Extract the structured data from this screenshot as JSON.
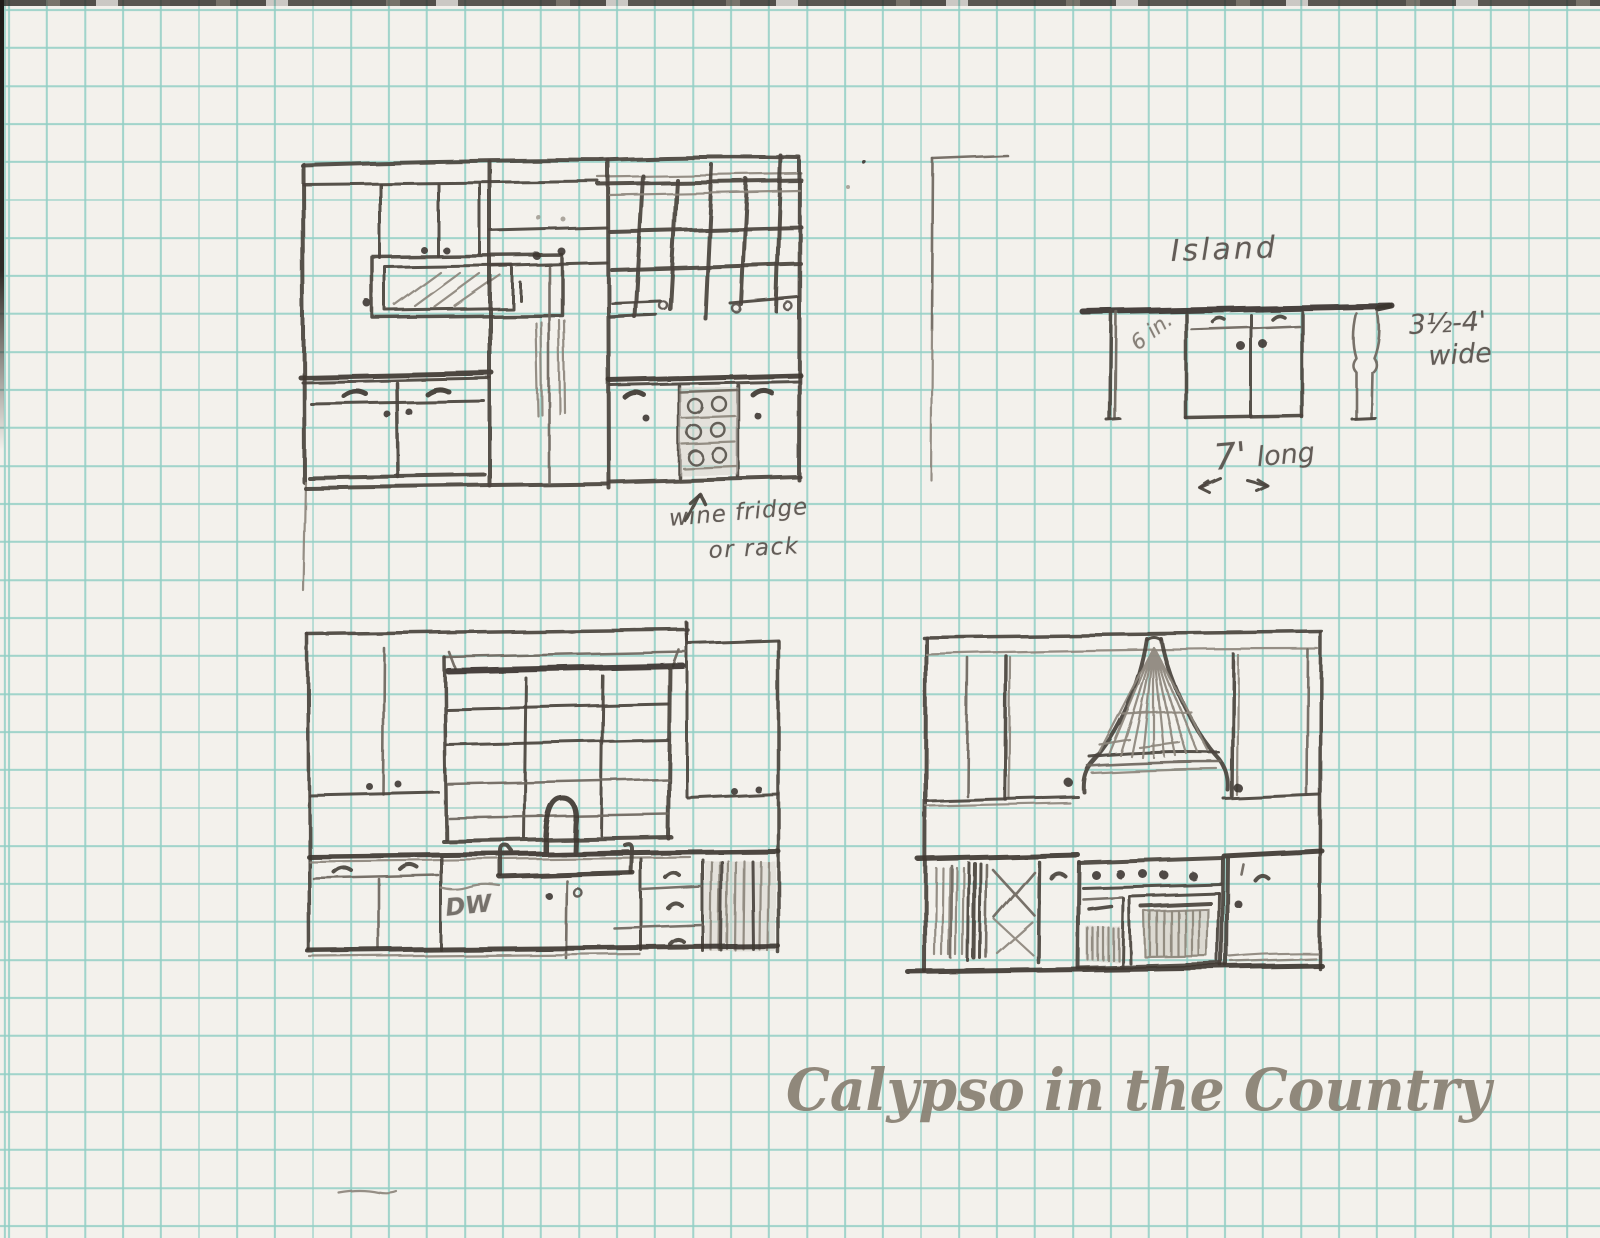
{
  "paper": {
    "background": "#f3f1ec",
    "grid_color": "#93cfc5",
    "pencil_color": "#4a443d",
    "scan_edge_color": "#25221e"
  },
  "labels": {
    "island_title": "Island",
    "island_depth_scribble": "6 in.",
    "island_width_line1": "3½-4'",
    "island_width_line2": "wide",
    "island_length_value": "7'",
    "island_length_word": "long",
    "wine_note_line1": "wine fridge",
    "wine_note_line2": "or rack",
    "dishwasher_label": "DW"
  },
  "watermark": {
    "text": "Calypso in the Country",
    "color": "#8a8174"
  }
}
